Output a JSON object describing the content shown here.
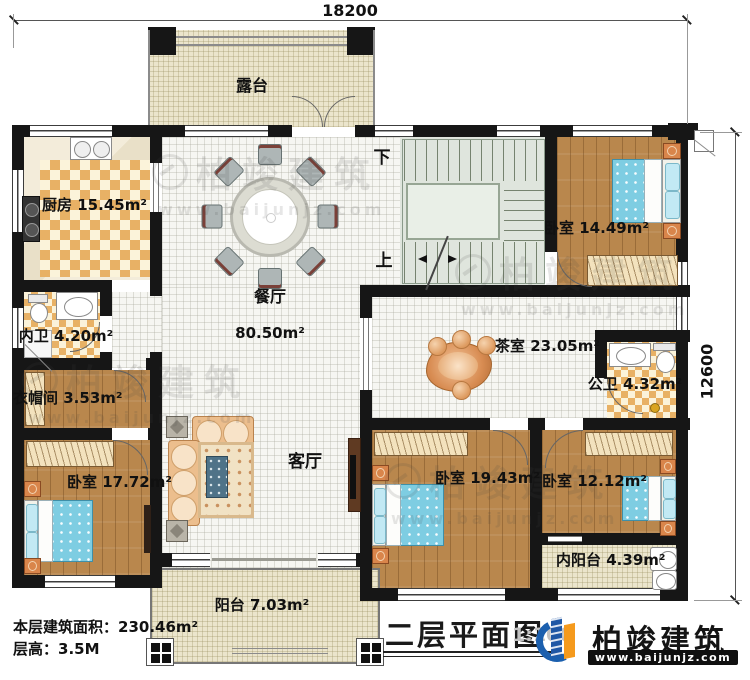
{
  "dimensions": {
    "top": "18200",
    "right": "12600"
  },
  "stairs": {
    "down": "下",
    "up": "上"
  },
  "rooms": {
    "terrace": {
      "name": "露台",
      "area": ""
    },
    "kitchen": {
      "name": "厨房",
      "area": "15.45m²"
    },
    "dining": {
      "name": "餐厅",
      "area": "80.50m²"
    },
    "bedroom_tr": {
      "name": "卧室",
      "area": "14.49m²"
    },
    "inner_bath": {
      "name": "内卫",
      "area": "4.20m²"
    },
    "cloakroom": {
      "name": "衣帽间",
      "area": "3.53m²"
    },
    "tea_room": {
      "name": "茶室",
      "area": "23.05m²"
    },
    "public_bath": {
      "name": "公卫",
      "area": "4.32m²"
    },
    "bedroom_bl": {
      "name": "卧室",
      "area": "17.72m²"
    },
    "living": {
      "name": "客厅",
      "area": ""
    },
    "bedroom_bm": {
      "name": "卧室",
      "area": "19.43m²"
    },
    "bedroom_br": {
      "name": "卧室",
      "area": "12.12m²"
    },
    "inner_balcony": {
      "name": "内阳台",
      "area": "4.39m²"
    },
    "balcony": {
      "name": "阳台",
      "area": "7.03m²"
    }
  },
  "footer": {
    "floor_area_label": "本层建筑面积：",
    "floor_area_value": "230.46m²",
    "floor_height_label": "层高：",
    "floor_height_value": "3.5M"
  },
  "title_block": {
    "title": "二层平面图",
    "scale": "1:100",
    "brand": "柏竣建筑",
    "website": "www.baijunjz.com"
  },
  "watermark": {
    "brand": "柏竣建筑",
    "website": "www.baijunjz.com"
  },
  "colors": {
    "wall": "#161616",
    "wood_floor": "#b9874d",
    "checker_tile": "#e8b165",
    "terrace_floor": "#ebe5cc",
    "stair_floor": "#dfe5dd",
    "bed_blue": "#7ecde2",
    "brand_blue": "#1b5fae",
    "brand_orange": "#f59a1d"
  }
}
